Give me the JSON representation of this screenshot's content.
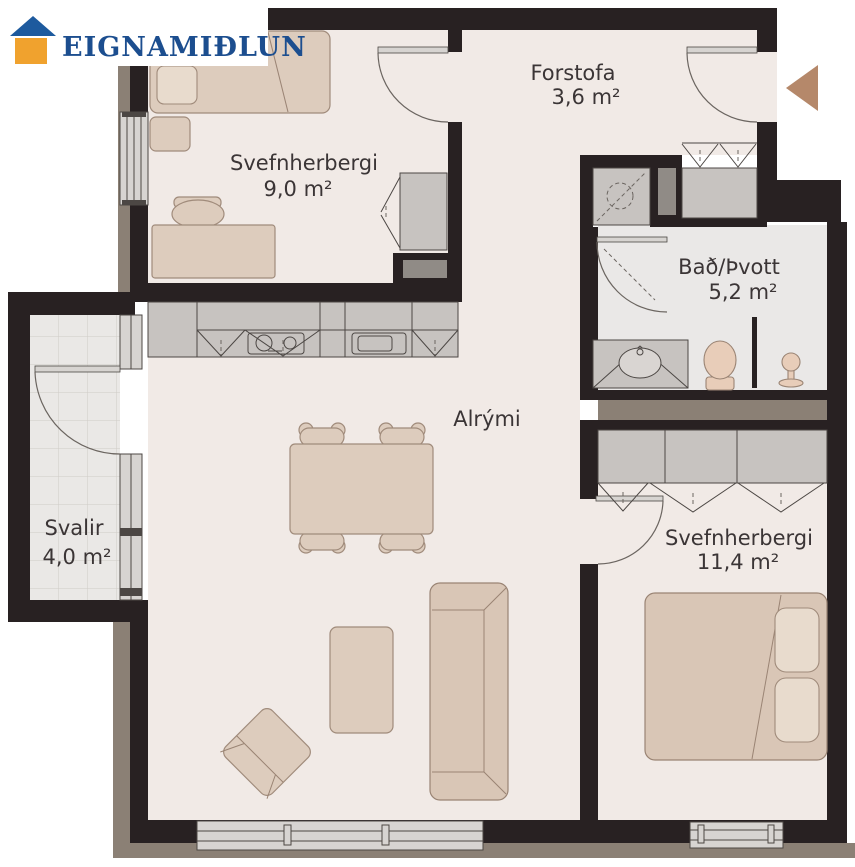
{
  "logo": {
    "brand": "EIGNAMIÐLUN",
    "roof_color": "#1d5a9e",
    "body_color": "#f0a22e",
    "text_color": "#1c4e8f"
  },
  "rooms": {
    "forstofa": {
      "name": "Forstofa",
      "area": "3,6 m²"
    },
    "svefnherbergi1": {
      "name": "Svefnherbergi",
      "area": "9,0 m²"
    },
    "bad": {
      "name": "Bað/Þvott",
      "area": "5,2 m²"
    },
    "alrymi": {
      "name": "Alrými",
      "area": ""
    },
    "svalir": {
      "name": "Svalir",
      "area": "4,0 m²"
    },
    "svefnherbergi2": {
      "name": "Svefnherbergi",
      "area": "11,4 m²"
    }
  },
  "colors": {
    "wall": "#282122",
    "floor": "#f1eae6",
    "bath_floor": "#eae8e7",
    "exterior_band": "#8b8075",
    "cabinet_gray": "#c7c3c0",
    "furniture_beige": "#ddccbd",
    "entrance_arrow": "#b5886a",
    "label_text": "#3b3536"
  },
  "icons": {
    "entrance_arrow": "left-pointing-triangle",
    "logo_house": "house"
  }
}
